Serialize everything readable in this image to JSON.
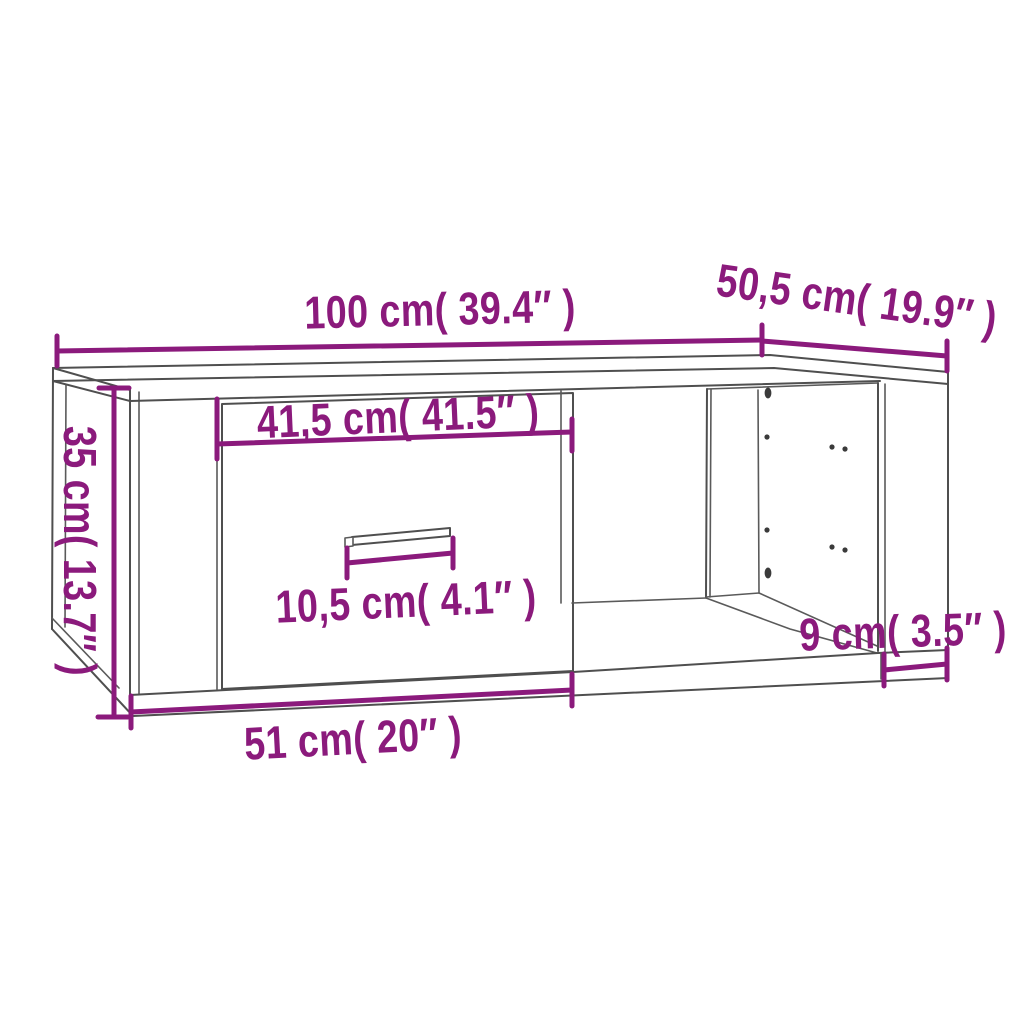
{
  "diagram": {
    "type": "furniture-dimension-line-drawing",
    "subject": "coffee table with drawer, handle and open shelf compartment",
    "colors": {
      "dimension_accent": "#8B1A7C",
      "outline": "#4F4F4F",
      "background": "#FFFFFF"
    },
    "labels": {
      "top_width": "100 cm( 39.4″ )",
      "top_depth": "50,5 cm( 19.9″ )",
      "side_height": "35 cm( 13.7″ )",
      "drawer_opening_width": "41,5 cm( 41.5″ )",
      "handle_width": "10,5 cm( 4.1″ )",
      "drawer_front_width": "51 cm( 20″ )",
      "right_offset": "9 cm( 3.5″ )"
    },
    "measurements": [
      {
        "name": "overall width",
        "cm": "100",
        "inches": "39.4"
      },
      {
        "name": "overall depth",
        "cm": "50,5",
        "inches": "19.9"
      },
      {
        "name": "overall height",
        "cm": "35",
        "inches": "13.7"
      },
      {
        "name": "drawer opening width",
        "cm": "41,5",
        "inches": "41.5"
      },
      {
        "name": "handle width",
        "cm": "10,5",
        "inches": "4.1"
      },
      {
        "name": "drawer front width",
        "cm": "51",
        "inches": "20"
      },
      {
        "name": "right compartment offset",
        "cm": "9",
        "inches": "3.5"
      }
    ]
  }
}
